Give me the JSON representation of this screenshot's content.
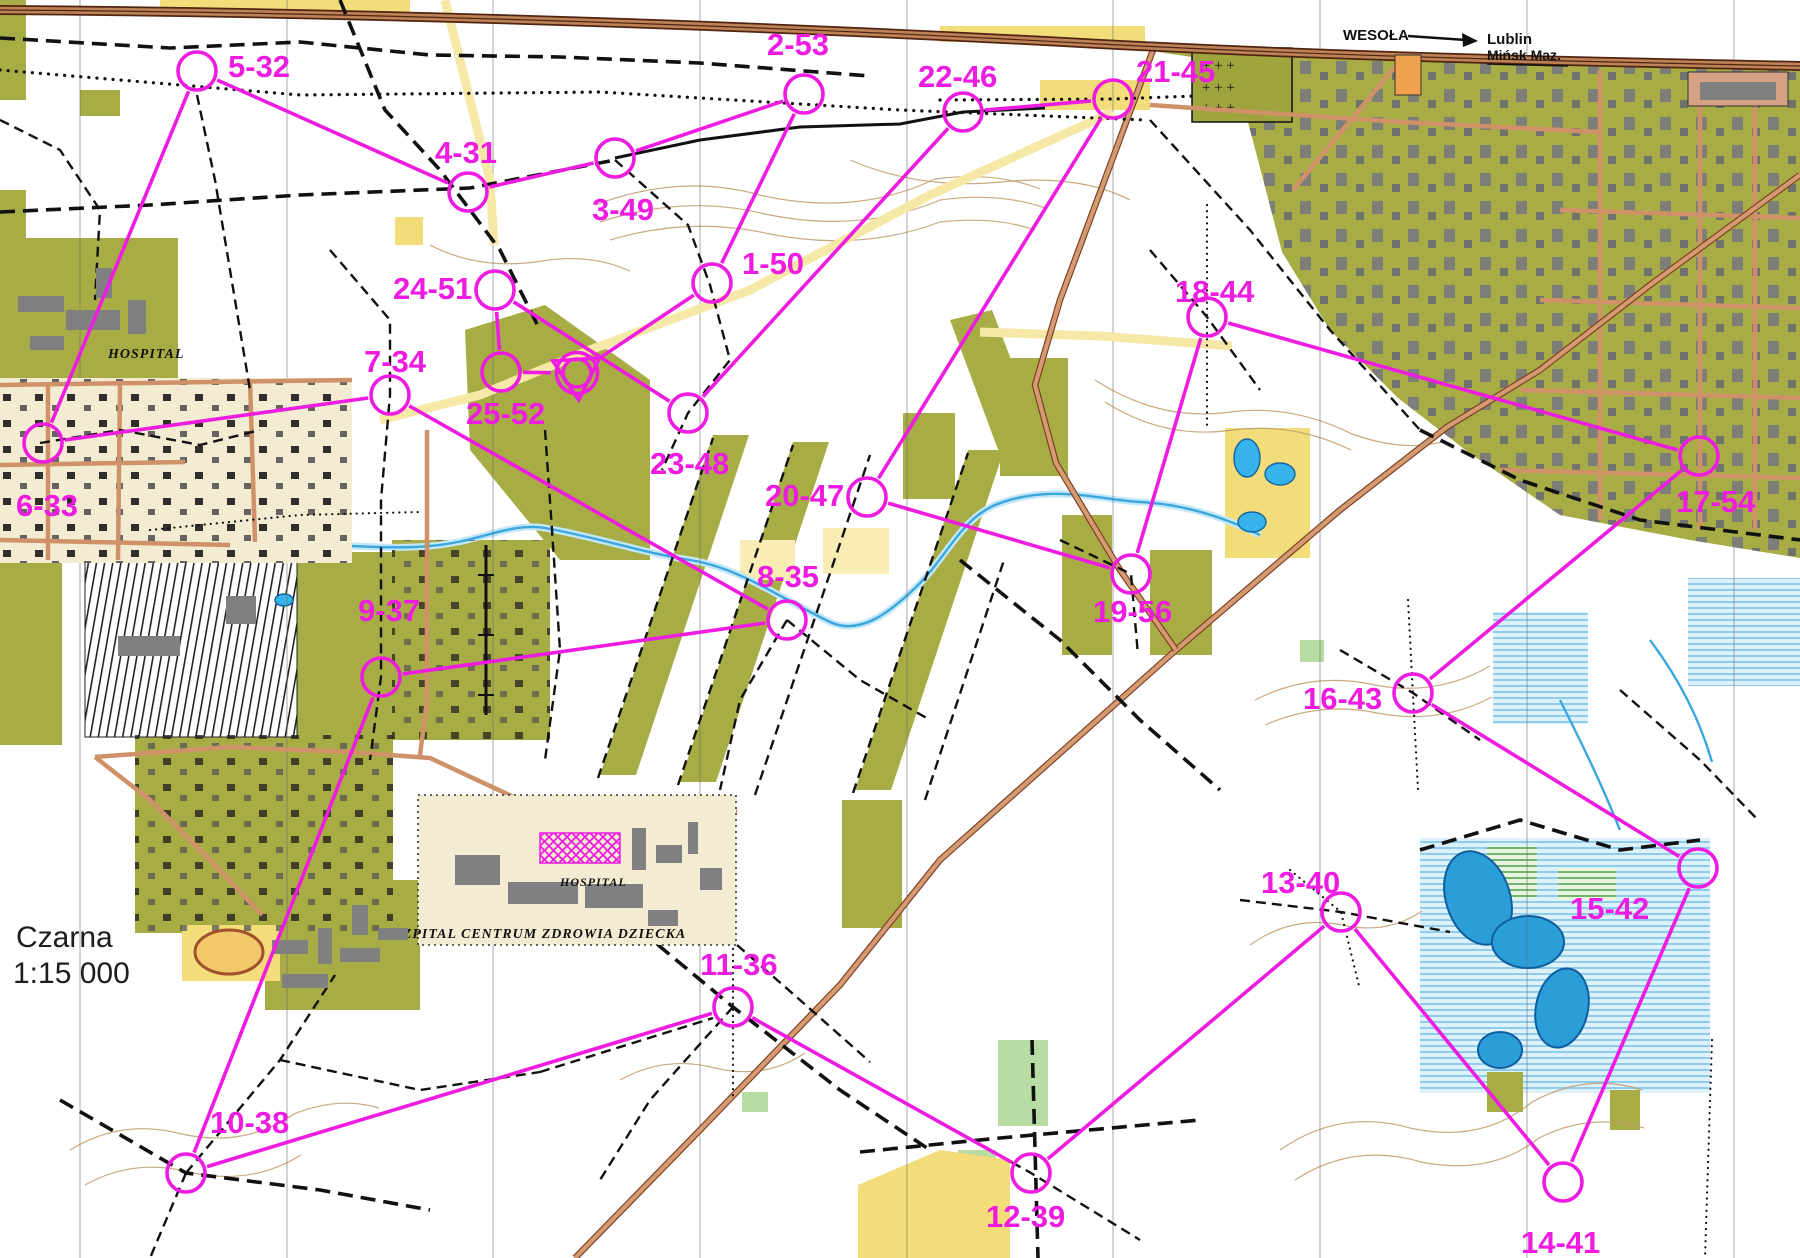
{
  "map": {
    "title": "Czarna",
    "scale": "1:15 000",
    "signpost": {
      "town": "WESOŁA",
      "destination1": "Lublin",
      "destination2": "Mińsk Maz."
    },
    "labels": {
      "hospital_west": "HOSPITAL",
      "hospital_south": "HOSPITAL",
      "hospital_south_name": "SZPITAL CENTRUM ZDROWIA DZIECKA"
    }
  },
  "palette": {
    "course_magenta": "#ee1ce0",
    "forest_white": "#ffffff",
    "settlement_olive": "#a8ac45",
    "open_yellow": "#f2dd7a",
    "water_blue": "#2b9ed8",
    "road_tan": "#d49b72",
    "path_black": "#111111"
  },
  "course": {
    "color": "#ee1ce0",
    "start_finish": {
      "x": 577,
      "y": 373
    },
    "controls": [
      {
        "seq": 1,
        "code": 50,
        "label": "1-50",
        "x": 712,
        "y": 283,
        "lx": 742,
        "ly": 247
      },
      {
        "seq": 2,
        "code": 53,
        "label": "2-53",
        "x": 804,
        "y": 94,
        "lx": 767,
        "ly": 28
      },
      {
        "seq": 3,
        "code": 49,
        "label": "3-49",
        "x": 615,
        "y": 158,
        "lx": 592,
        "ly": 193
      },
      {
        "seq": 4,
        "code": 31,
        "label": "4-31",
        "x": 468,
        "y": 192,
        "lx": 435,
        "ly": 136
      },
      {
        "seq": 5,
        "code": 32,
        "label": "5-32",
        "x": 197,
        "y": 71,
        "lx": 228,
        "ly": 50
      },
      {
        "seq": 6,
        "code": 33,
        "label": "6-33",
        "x": 43,
        "y": 443,
        "lx": 16,
        "ly": 489
      },
      {
        "seq": 7,
        "code": 34,
        "label": "7-34",
        "x": 390,
        "y": 395,
        "lx": 364,
        "ly": 345
      },
      {
        "seq": 8,
        "code": 35,
        "label": "8-35",
        "x": 787,
        "y": 620,
        "lx": 757,
        "ly": 560
      },
      {
        "seq": 9,
        "code": 37,
        "label": "9-37",
        "x": 381,
        "y": 677,
        "lx": 358,
        "ly": 594
      },
      {
        "seq": 10,
        "code": 38,
        "label": "10-38",
        "x": 186,
        "y": 1173,
        "lx": 210,
        "ly": 1106
      },
      {
        "seq": 11,
        "code": 36,
        "label": "11-36",
        "x": 733,
        "y": 1007,
        "lx": 700,
        "ly": 948
      },
      {
        "seq": 12,
        "code": 39,
        "label": "12-39",
        "x": 1031,
        "y": 1173,
        "lx": 986,
        "ly": 1200
      },
      {
        "seq": 13,
        "code": 40,
        "label": "13-40",
        "x": 1341,
        "y": 912,
        "lx": 1261,
        "ly": 866
      },
      {
        "seq": 14,
        "code": 41,
        "label": "14-41",
        "x": 1563,
        "y": 1182,
        "lx": 1521,
        "ly": 1226
      },
      {
        "seq": 15,
        "code": 42,
        "label": "15-42",
        "x": 1698,
        "y": 868,
        "lx": 1570,
        "ly": 892
      },
      {
        "seq": 16,
        "code": 43,
        "label": "16-43",
        "x": 1413,
        "y": 693,
        "lx": 1303,
        "ly": 682
      },
      {
        "seq": 17,
        "code": 54,
        "label": "17-54",
        "x": 1699,
        "y": 456,
        "lx": 1676,
        "ly": 485
      },
      {
        "seq": 18,
        "code": 44,
        "label": "18-44",
        "x": 1207,
        "y": 317,
        "lx": 1175,
        "ly": 275
      },
      {
        "seq": 19,
        "code": 56,
        "label": "19-56",
        "x": 1131,
        "y": 574,
        "lx": 1093,
        "ly": 595
      },
      {
        "seq": 20,
        "code": 47,
        "label": "20-47",
        "x": 867,
        "y": 497,
        "lx": 765,
        "ly": 479
      },
      {
        "seq": 21,
        "code": 45,
        "label": "21-45",
        "x": 1113,
        "y": 99,
        "lx": 1136,
        "ly": 55
      },
      {
        "seq": 22,
        "code": 46,
        "label": "22-46",
        "x": 963,
        "y": 112,
        "lx": 918,
        "ly": 60
      },
      {
        "seq": 23,
        "code": 48,
        "label": "23-48",
        "x": 688,
        "y": 413,
        "lx": 650,
        "ly": 447
      },
      {
        "seq": 24,
        "code": 51,
        "label": "24-51",
        "x": 495,
        "y": 290,
        "lx": 393,
        "ly": 272
      },
      {
        "seq": 25,
        "code": 52,
        "label": "25-52",
        "x": 501,
        "y": 372,
        "lx": 466,
        "ly": 397
      }
    ]
  }
}
